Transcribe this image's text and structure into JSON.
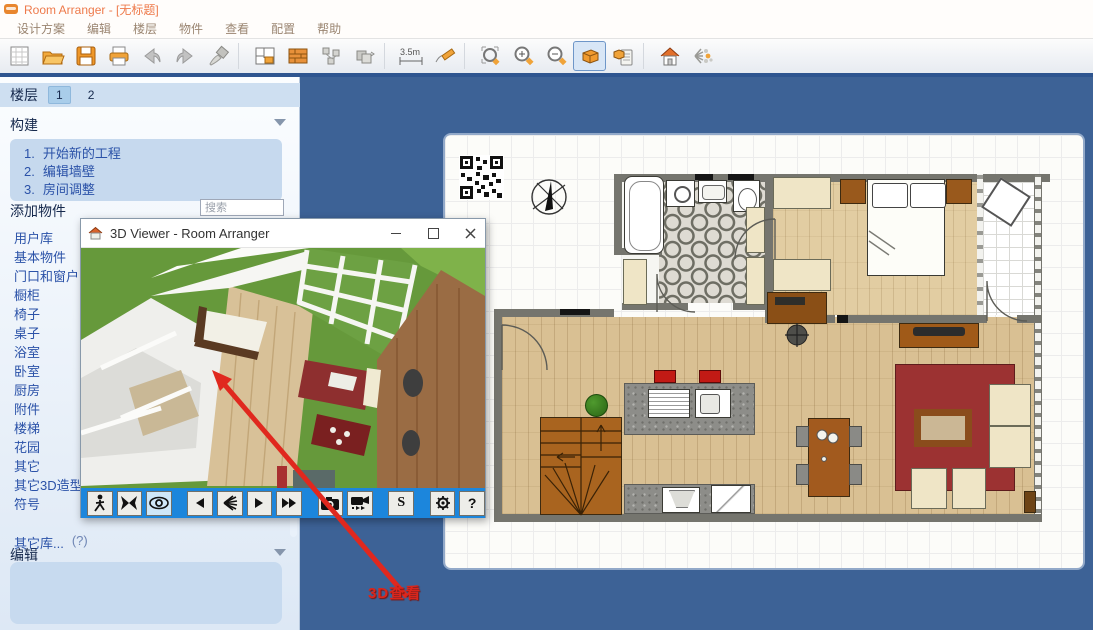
{
  "window": {
    "title": "Room Arranger - [无标题]"
  },
  "menubar": {
    "items": [
      "设计方案",
      "编辑",
      "楼层",
      "物件",
      "查看",
      "配置",
      "帮助"
    ]
  },
  "toolbar": {
    "ruler_label": "3.5m",
    "icons": [
      "new-document",
      "open-folder",
      "save",
      "print",
      "undo",
      "redo",
      "format-brush",
      "floor-plan",
      "wall-brick",
      "select-objects",
      "group-objects",
      "measure",
      "draw-pencil",
      "zoom-fit",
      "zoom-in",
      "zoom-out",
      "view-3d",
      "copy-3d-view",
      "house",
      "explode-view"
    ],
    "selected": "view-3d"
  },
  "sidebar": {
    "floors": {
      "label": "楼层",
      "tabs": [
        "1",
        "2"
      ],
      "active_tab": "1"
    },
    "build": {
      "label": "构建",
      "steps": [
        {
          "num": "1.",
          "text": "开始新的工程"
        },
        {
          "num": "2.",
          "text": "编辑墙壁"
        },
        {
          "num": "3.",
          "text": "房间调整"
        }
      ]
    },
    "add_objects": {
      "label": "添加物件",
      "search_placeholder": "搜索",
      "categories": [
        "用户库",
        "基本物件",
        "门口和窗户",
        "橱柜",
        "椅子",
        "桌子",
        "浴室",
        "卧室",
        "厨房",
        "附件",
        "楼梯",
        "花园",
        "其它",
        "其它3D造型",
        "符号"
      ]
    },
    "other_libraries": {
      "label": "其它库...",
      "hint": "(?)"
    },
    "edit": {
      "label": "编辑"
    }
  },
  "viewer3d": {
    "title": "3D Viewer - Room Arranger",
    "toolbar_icons": [
      "walk",
      "fly",
      "look-around",
      "step-back",
      "light",
      "play",
      "fast-forward",
      "screenshot",
      "record-video",
      "stereo",
      "settings",
      "help"
    ],
    "stereo_label": "S",
    "help_label": "?"
  },
  "annotation": {
    "text": "3D查看"
  },
  "colors": {
    "app_background": "#3d6296",
    "viewer_toolbar_blue": "#1c86dc",
    "accent_orange": "#ee7a4b",
    "link_blue": "#2b52a8",
    "annotation_red": "#d9261c"
  }
}
